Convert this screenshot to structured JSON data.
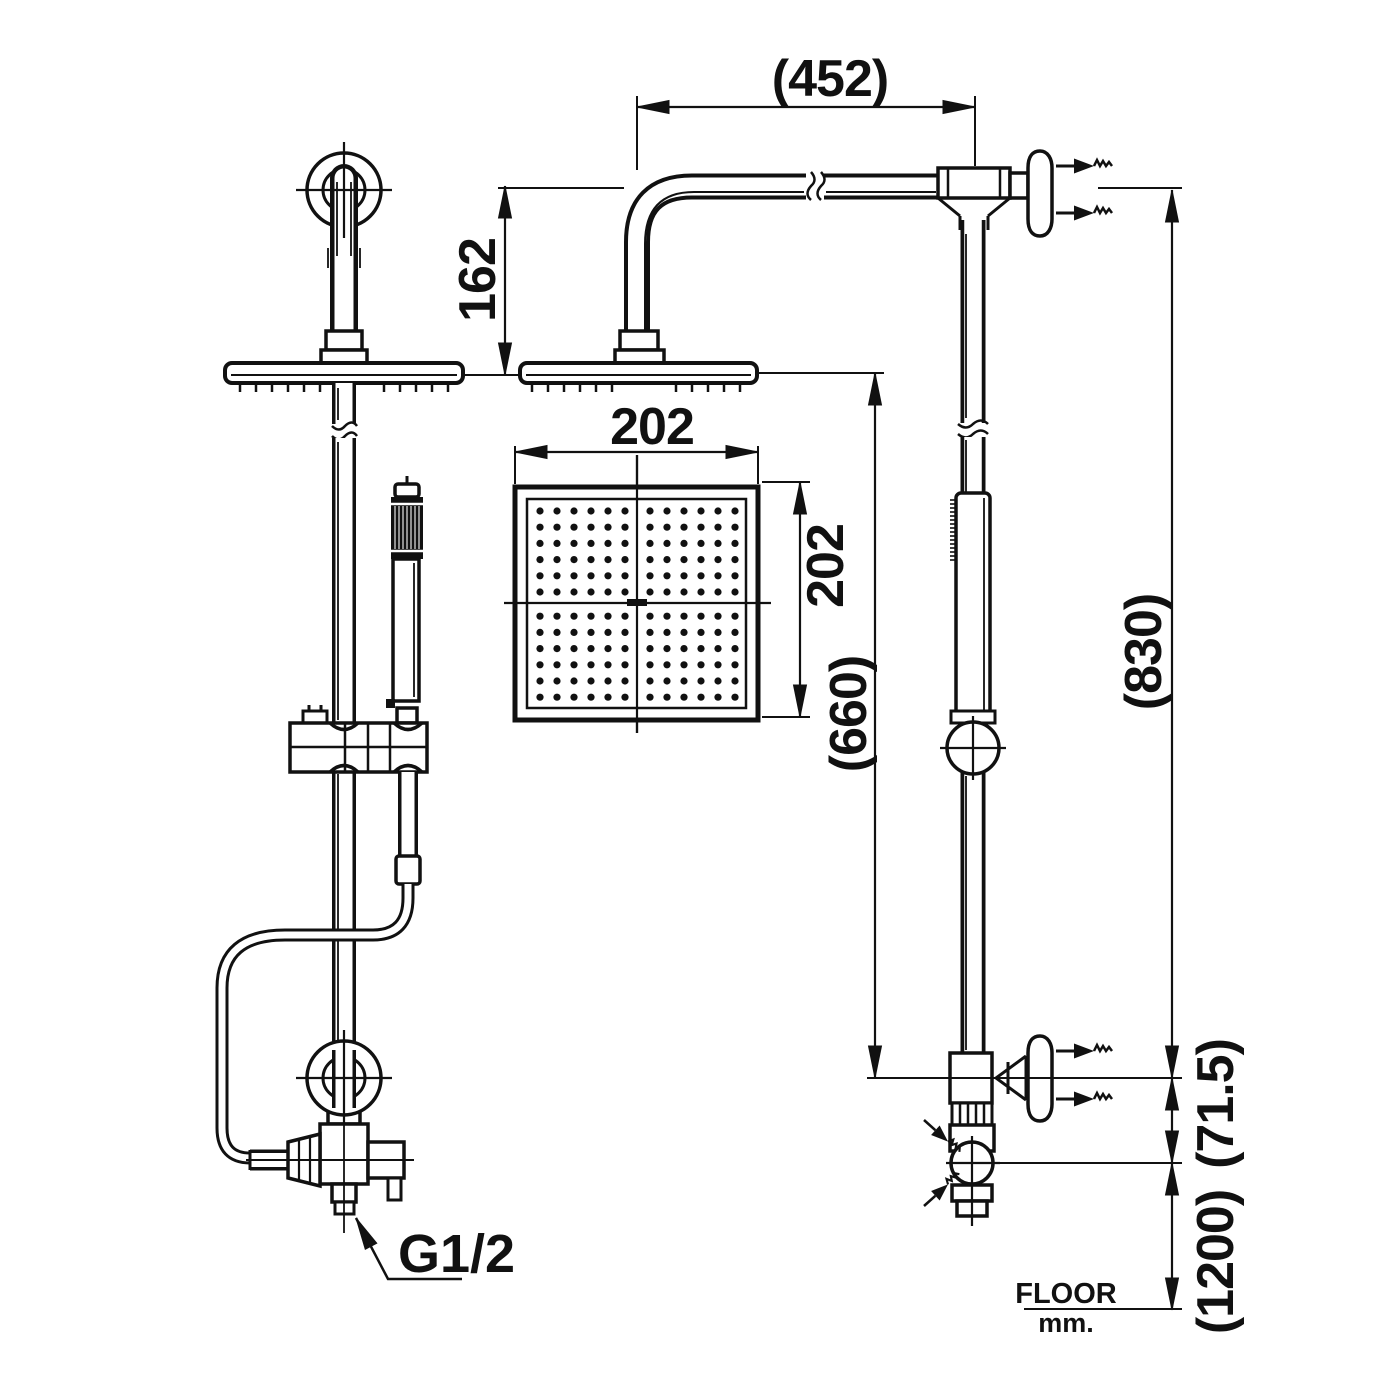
{
  "page": {
    "background": "#ffffff",
    "ink": "#111111"
  },
  "dimensions": {
    "arm_reach": "(452)",
    "head_drop": "162",
    "head_width": "202",
    "head_depth": "202",
    "head_to_supply": "(660)",
    "supply_to_top": "(830)",
    "supply_to_valve": "(71.5)",
    "valve_to_floor": "(1200)"
  },
  "labels": {
    "inlet_thread": "G1/2",
    "floor": "FLOOR",
    "units": "mm."
  },
  "drawing": {
    "nozzle_grid": {
      "cols": 12,
      "rows": 12,
      "x0": 540,
      "y0": 511,
      "sx": 17,
      "sy": 16.2,
      "gap_col": 6,
      "gap_row": 6,
      "gap": 8,
      "dot_r": 3.6
    },
    "head_ticks": {
      "tick_y1": 383,
      "tick_y2": 392,
      "step": 16,
      "rows": [
        {
          "x0": 240,
          "x1": 450,
          "skip0": 322,
          "skip1": 372
        },
        {
          "x0": 532,
          "x1": 748,
          "skip0": 614,
          "skip1": 668
        }
      ]
    },
    "grip_stripes": {
      "x0": 395,
      "x1": 420,
      "step": 4,
      "y0": 506,
      "y1": 549
    },
    "side_grip_ribs": {
      "y0": 500,
      "y1": 560,
      "step": 4,
      "x0": 950,
      "x1": 957
    }
  }
}
